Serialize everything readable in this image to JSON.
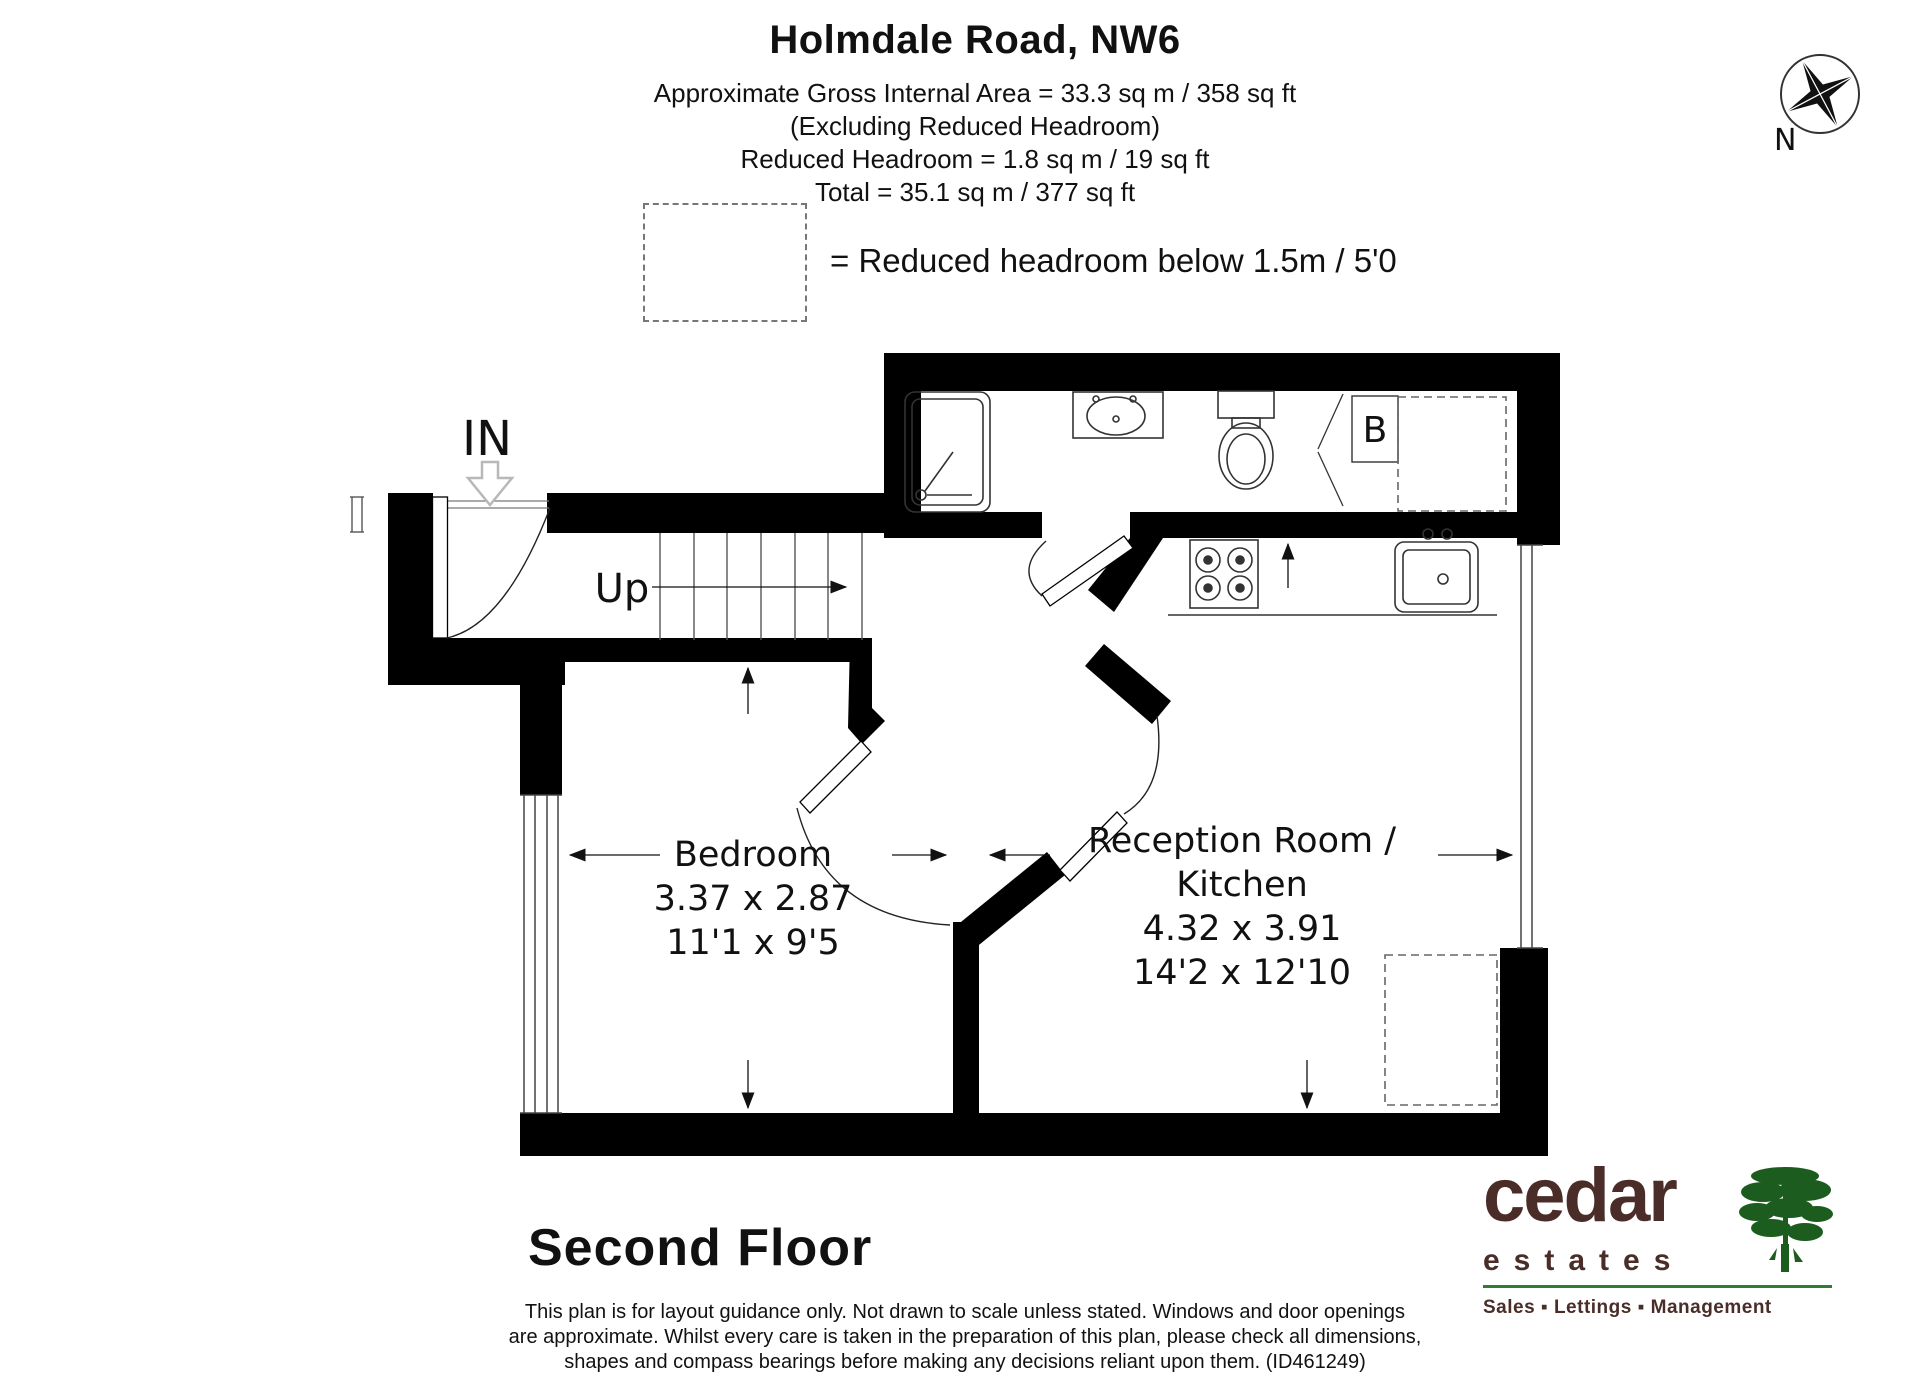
{
  "header": {
    "title": "Holmdale Road, NW6",
    "line1": "Approximate Gross Internal Area = 33.3 sq m / 358 sq ft",
    "line2": "(Excluding Reduced Headroom)",
    "line3": "Reduced Headroom = 1.8 sq m / 19 sq ft",
    "line4": "Total = 35.1 sq m / 377 sq ft"
  },
  "legend": {
    "label": "= Reduced headroom below 1.5m / 5'0"
  },
  "compass": {
    "north_label": "N"
  },
  "plan": {
    "in_label": "IN",
    "up_label": "Up",
    "boiler_label": "B"
  },
  "rooms": {
    "bedroom": {
      "name": "Bedroom",
      "metric": "3.37 x 2.87",
      "imperial": "11'1 x 9'5"
    },
    "reception": {
      "name_line1": "Reception Room /",
      "name_line2": "Kitchen",
      "metric": "4.32 x 3.91",
      "imperial": "14'2 x 12'10"
    }
  },
  "floor": {
    "label": "Second Floor"
  },
  "disclaimer": {
    "line1": "This plan is for layout guidance only. Not drawn to scale unless stated. Windows and door openings",
    "line2": "are approximate. Whilst every care is taken in the preparation of this plan, please check all dimensions,",
    "line3": "shapes and compass bearings before making any decisions reliant upon them. (ID461249)"
  },
  "logo": {
    "name": "cedar",
    "sub": "estates",
    "tagline": "Sales ▪ Lettings ▪ Management"
  },
  "colors": {
    "wall": "#000000",
    "brand_brown": "#4a2d28",
    "brand_green": "#1c5c1e",
    "rule_green": "#2e7d32"
  }
}
